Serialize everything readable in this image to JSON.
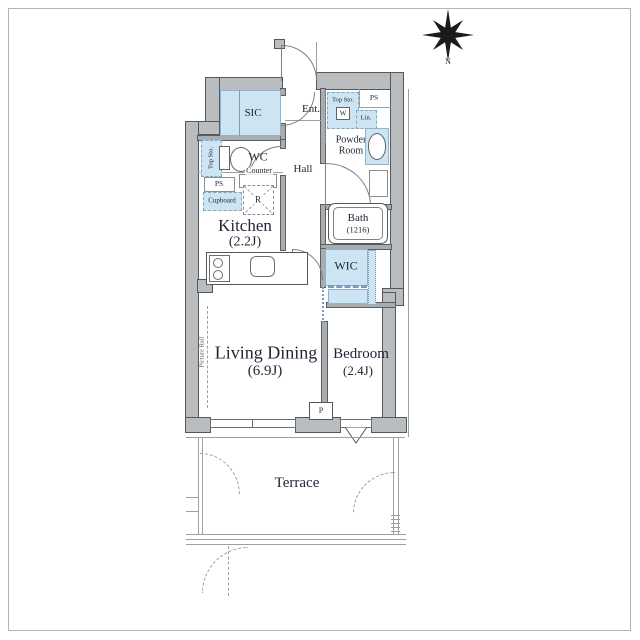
{
  "colors": {
    "wall_fill": "#b9bdbf",
    "wall_edge": "#54585a",
    "room_blue": "#cde4f3",
    "blue_edge": "#7ea6c6",
    "line": "#7d8184",
    "text": "#1d2433"
  },
  "compass": {
    "north": "N"
  },
  "labels": {
    "sic": "SIC",
    "entrance": "Ent.",
    "entry_top_storage": "Top Sto.",
    "washer": "W",
    "ps_top": "PS",
    "linen": "Lin.",
    "powder_room": "Powder Room",
    "wc": "WC",
    "wc_top_storage": "Top Sto.",
    "wc_counter": "Counter",
    "hall": "Hall",
    "ps_kitchen": "PS",
    "cupboard": "Cupboard",
    "refrigerator": "R",
    "kitchen_name": "Kitchen",
    "kitchen_size": "(2.2J)",
    "bath_name": "Bath",
    "bath_size": "(1216)",
    "wic": "WIC",
    "living_name": "Living Dining",
    "living_size": "(6.9J)",
    "bedroom_name": "Bedroom",
    "bedroom_size": "(2.4J)",
    "pillar": "P",
    "terrace": "Terrace",
    "picture_rail": "Picture Rail"
  }
}
